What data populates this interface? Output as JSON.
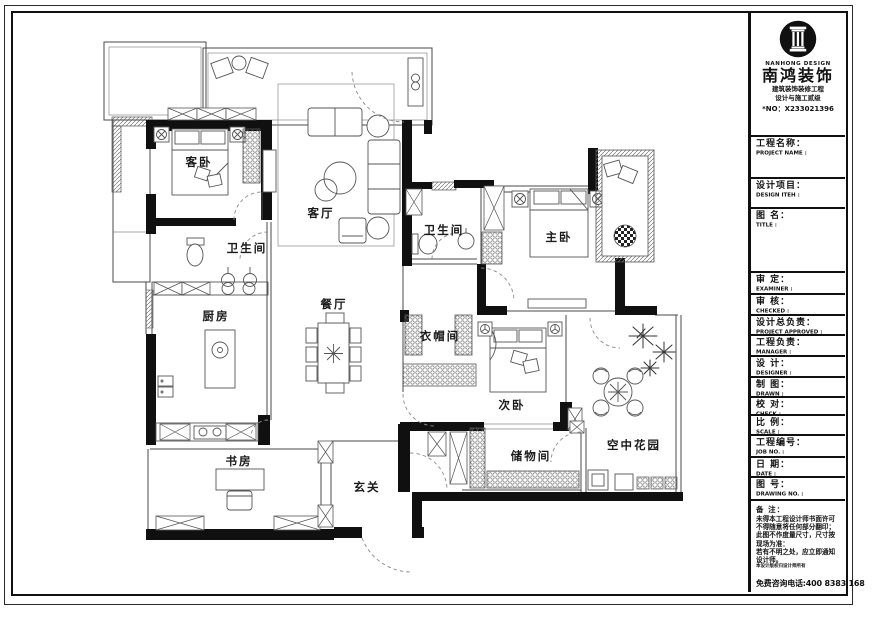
{
  "company": {
    "logo_text": "NANHONG DESIGN",
    "name_cn": "南鸿装饰",
    "cert_line1": "建筑装饰装修工程",
    "cert_line2": "设计与施工贰级",
    "cert_no": "*NO：X233021396"
  },
  "titleblock": {
    "fields": [
      {
        "cn": "工程名称：",
        "en": "PROJECT NAME :"
      },
      {
        "cn": "设计项目：",
        "en": "DESIGN ITEH :"
      },
      {
        "cn": "图 名：",
        "en": "TITLE :"
      },
      {
        "cn": "审 定：",
        "en": "EXAMINER :"
      },
      {
        "cn": "审 核：",
        "en": "CHECKED :"
      },
      {
        "cn": "设计总负责：",
        "en": "PROJECT APPROVED :"
      },
      {
        "cn": "工程负责：",
        "en": "MANAGER :"
      },
      {
        "cn": "设 计：",
        "en": "DESIGNER :"
      },
      {
        "cn": "制 图：",
        "en": "DRAWN :"
      },
      {
        "cn": "校 对：",
        "en": "CHECK :"
      },
      {
        "cn": "比 例：",
        "en": "SCALE :"
      },
      {
        "cn": "工程编号：",
        "en": "JOB NO. :"
      },
      {
        "cn": "日 期：",
        "en": "DATE :"
      },
      {
        "cn": "图 号：",
        "en": "DRAWING NO. :"
      }
    ],
    "notes": {
      "label": "备 注：",
      "lines": [
        "未得本工程设计师书面许可不得随意将任何部分翻印；",
        "此图不作度量尺寸，尺寸按现场为准：",
        "若有不明之处，应立即通知设计师。",
        "本设计版权归设计师所有"
      ],
      "hotline": "免费咨询电话:400 8383 168"
    }
  },
  "floorplan": {
    "rooms": [
      {
        "name": "客卧"
      },
      {
        "name": "客厅"
      },
      {
        "name": "卫生间"
      },
      {
        "name": "卫生间"
      },
      {
        "name": "主卧"
      },
      {
        "name": "厨房"
      },
      {
        "name": "餐厅"
      },
      {
        "name": "衣帽间"
      },
      {
        "name": "次卧"
      },
      {
        "name": "书房"
      },
      {
        "name": "玄关"
      },
      {
        "name": "储物间"
      },
      {
        "name": "空中花园"
      }
    ]
  },
  "colors": {
    "wall": "#101010",
    "line": "#555555",
    "paper": "#ffffff"
  }
}
